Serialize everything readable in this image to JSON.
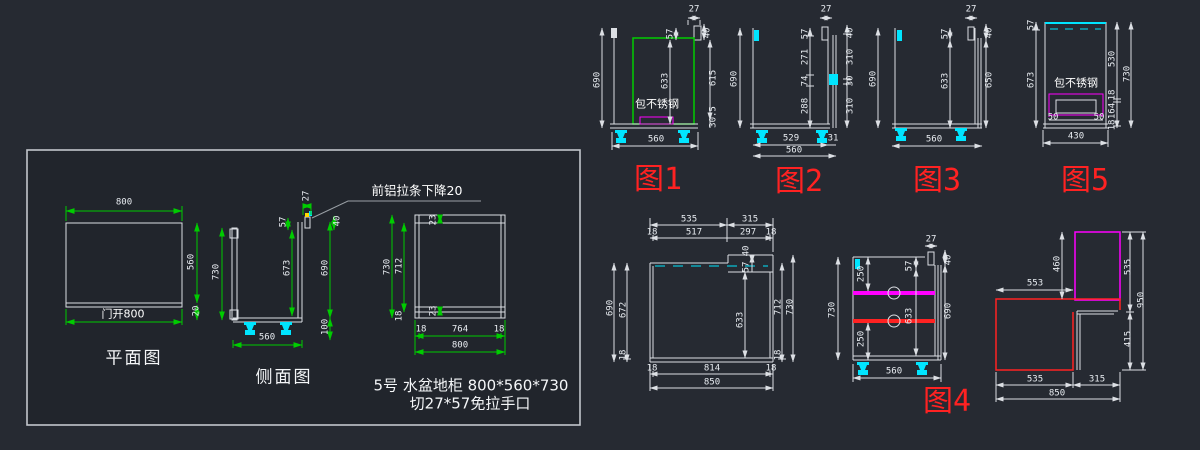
{
  "colors": {
    "background": "#262a32",
    "panel_background": "#21252c",
    "line_white": "#dcdfe4",
    "dim_green": "#00cc00",
    "highlight_cyan": "#00e5ff",
    "magenta": "#ff00ff",
    "red": "#ff2222"
  },
  "panel": {
    "plan": {
      "title": "平面图",
      "width": "800",
      "depth": "560",
      "back": "20",
      "door": "门开800"
    },
    "side": {
      "title": "侧面图",
      "height": "730",
      "top": "27",
      "cut": "57",
      "drop": "40",
      "inner": "673",
      "body": "690",
      "leg": "100",
      "depth": "560"
    },
    "callout": "前铝拉条下降20",
    "front": {
      "height": "730",
      "inner": "712",
      "base": "18",
      "rail_top": "23",
      "rail_bottom": "23",
      "bl": "18",
      "bm": "764",
      "br": "18",
      "total": "800"
    },
    "caption1": "5号 水盆地柜 800*560*730",
    "caption2": "切27*57免拉手口"
  },
  "fig1": {
    "label": "图1",
    "note": "包不锈钢",
    "top": "27",
    "cut": "57",
    "drop": "40",
    "height": "690",
    "door": "633",
    "side": "615",
    "toe": "30.5",
    "width": "560"
  },
  "fig2": {
    "label": "图2",
    "top": "27",
    "cut": "57",
    "s1": "271",
    "s2": "74",
    "s3": "288",
    "drop": "40",
    "r1": "310",
    "r2": "30",
    "r3": "310",
    "height": "690",
    "w1": "529",
    "w2": "31",
    "width": "560"
  },
  "fig3": {
    "label": "图3",
    "top": "27",
    "cut": "57",
    "height": "690",
    "door": "633",
    "drop": "40",
    "side": "650",
    "width": "560"
  },
  "fig4": {
    "label": "图4",
    "top": "27",
    "cut": "57",
    "drop": "40",
    "height": "730",
    "s1": "250",
    "s2": "250",
    "door": "633",
    "side": "690",
    "width": "560"
  },
  "fig5": {
    "label": "图5",
    "note": "包不锈钢",
    "cut": "57",
    "inner": "673",
    "r1": "530",
    "r2": "18",
    "r3": "164",
    "r4": "18",
    "height": "730",
    "p1": "50",
    "p2": "50",
    "width": "430"
  },
  "fig6": {
    "t1": "535",
    "t2": "315",
    "t3": "18",
    "t4": "517",
    "t5": "297",
    "t6": "18",
    "step": "40",
    "cut": "57",
    "l1": "690",
    "l2": "672",
    "l3": "18",
    "door": "633",
    "r1": "712",
    "r2": "730",
    "r3": "18",
    "b1": "18",
    "b2": "814",
    "b3": "18",
    "total": "850"
  },
  "fig7": {
    "v1": "460",
    "h1": "553",
    "r1": "535",
    "r2": "950",
    "r3": "415",
    "b1": "535",
    "b2": "315",
    "total": "850"
  }
}
